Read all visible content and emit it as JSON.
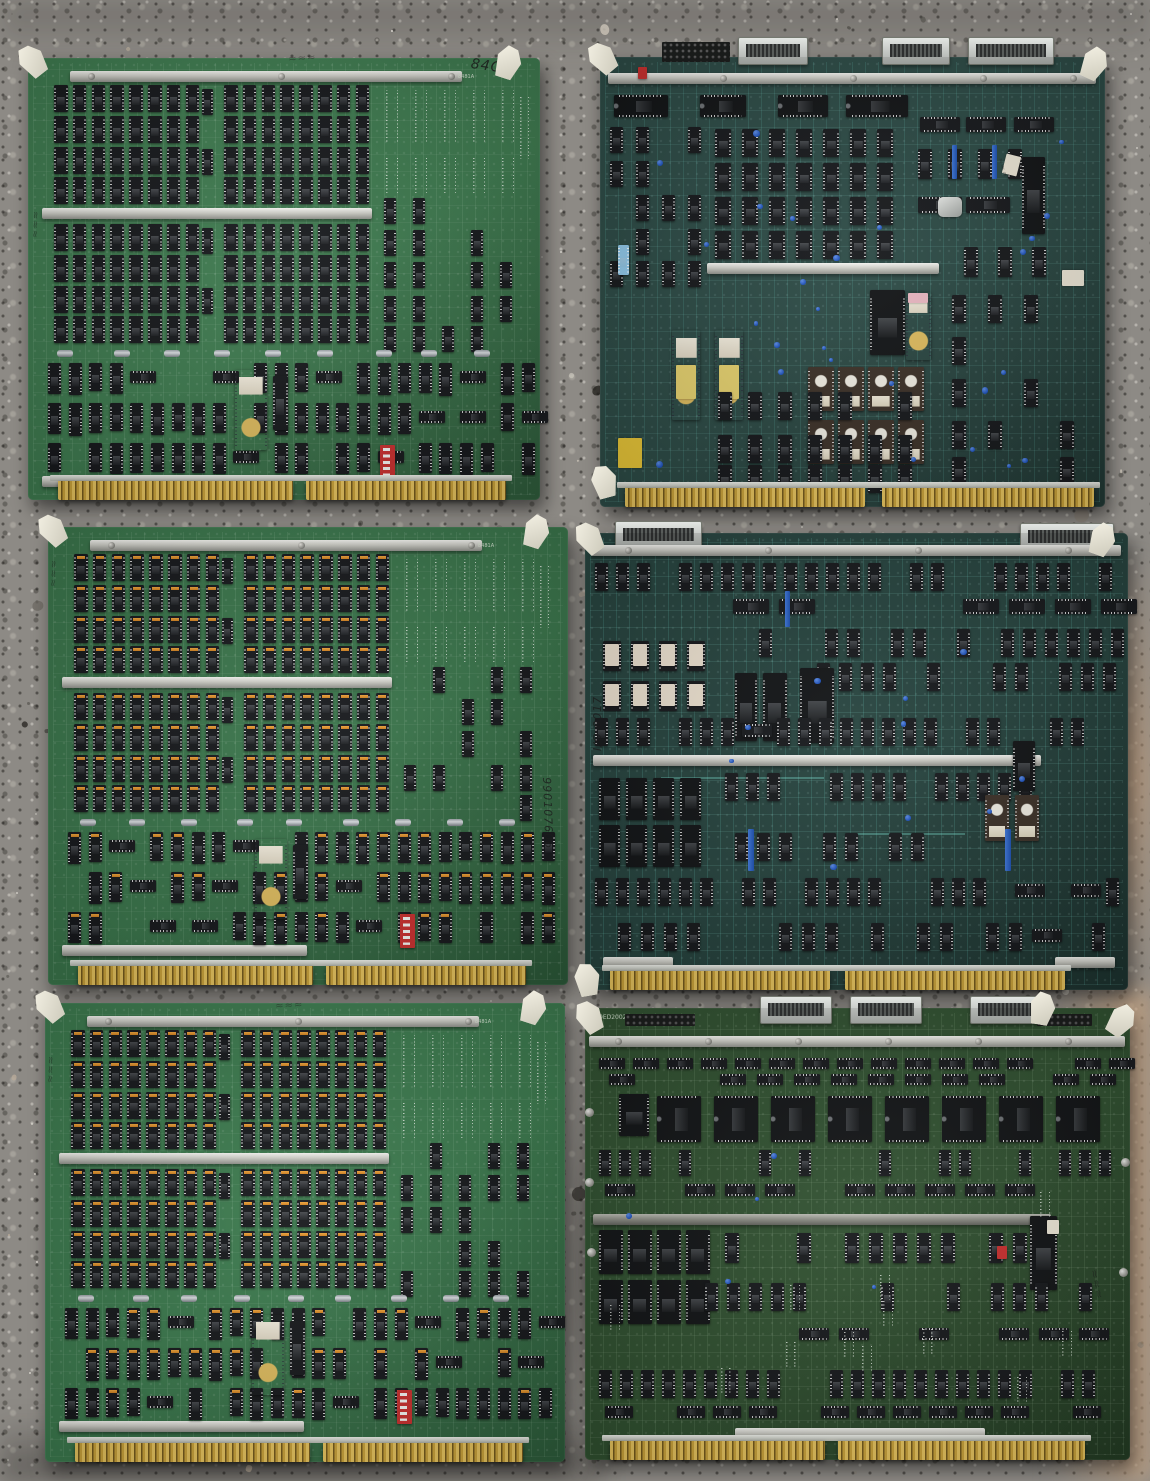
{
  "scene": {
    "description": "Top-down photograph of six vintage computer circuit boards arranged in a 2-column, 3-row grid on speckled concrete",
    "surface": "concrete",
    "colors": {
      "concrete_base": "#8d8a85",
      "concrete_dark_speckle": "#34312d",
      "concrete_light_speckle": "#d9d4ca",
      "concrete_warm_patch": "#c2a184"
    }
  },
  "shared": {
    "colors": {
      "gold_edge_connector": "#c9a23b",
      "metal_rail": "#d7d8d2",
      "ejector_tab": "#eae6d7",
      "dip_switch_red": "#c8302f",
      "eprom_body": "#3c3128",
      "eprom_label": "#efece2",
      "orange_pin1_mark": "#e1932f",
      "capacitor_blue": "#2157c9",
      "purple_ceramic_ic": "#8e80a6",
      "chip_black": "#17191c"
    },
    "scribble_glyph": "≈≈≈"
  },
  "boards": [
    {
      "id": "top-left",
      "type": "DRAM memory array board",
      "pcb_color": "#3e7a4f",
      "handwriting": "84C",
      "corner_silkscreen": "8481A",
      "notable": [
        "two banks of black DIP memory chips",
        "metal stiffener rails",
        "purple ceramic IC with gold cap",
        "red DIP switch",
        "gold edge connector",
        "white nylon ejector tabs"
      ]
    },
    {
      "id": "top-right",
      "type": "processor board",
      "pcb_color": "#2c4a45",
      "notable": [
        "three silver ribbon-cable headers",
        "row of four 40-pin DIPs",
        "bank of windowed EPROMs with foil labels",
        "two purple ICs with yellow labels",
        "metal crystal can",
        "blue disc capacitors",
        "yellow component",
        "two-segment gold edge connector"
      ]
    },
    {
      "id": "middle-left",
      "type": "DRAM memory array board",
      "pcb_color": "#3a754b",
      "handwriting": "990107606",
      "corner_silkscreen": "8481A",
      "notable": [
        "memory chips with orange pin-1 marks",
        "metal stiffener rails",
        "purple ceramic IC",
        "red DIP switch",
        "gold edge connector"
      ]
    },
    {
      "id": "middle-right",
      "type": "logic board",
      "pcb_color": "#26433e",
      "handwriting": "I/O 0017",
      "notable": [
        "dense rows of TTL logic DIPs",
        "bright cyan traces",
        "white-labelled ICs",
        "blue tantalum capacitors",
        "two-segment gold edge connector"
      ]
    },
    {
      "id": "bottom-left",
      "type": "DRAM memory array board",
      "pcb_color": "#3c7a4e",
      "corner_silkscreen": "8481A",
      "notable": [
        "memory chips with orange pin-1 marks",
        "metal stiffener rails",
        "purple ceramic IC",
        "red DIP switch",
        "gold edge connector"
      ]
    },
    {
      "id": "bottom-right",
      "type": "logic board",
      "pcb_color": "#305030",
      "silkscreen": "9ED2002 7-C01 REV",
      "notable": [
        "three silver ribbon-cable headers",
        "row of large DIP ICs",
        "large 40-pin DIP with white label",
        "small red DIP switch",
        "two-segment gold edge connector"
      ]
    }
  ]
}
